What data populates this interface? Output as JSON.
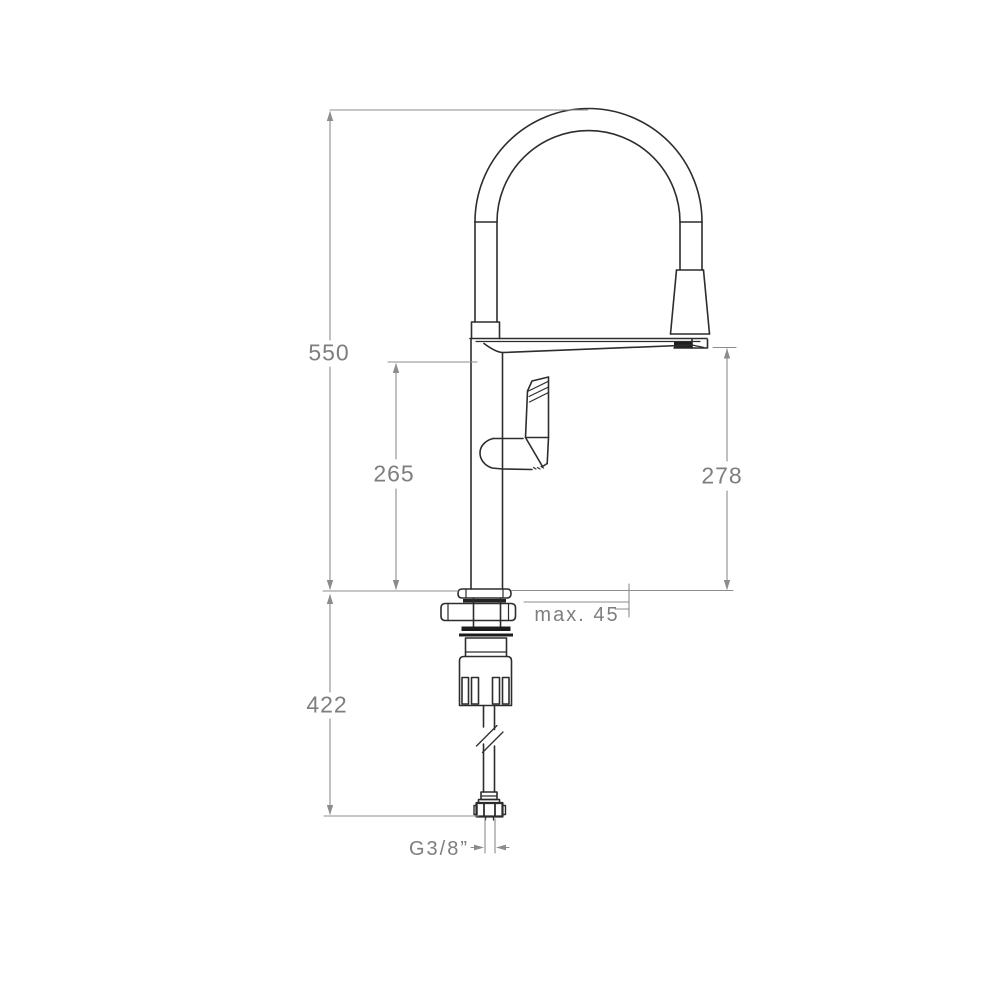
{
  "drawing": {
    "subject": "kitchen-mixer-tap-technical-drawing",
    "view": "front elevation with installation dimensions",
    "line_color": "#2d2d2d",
    "dimension_line_color": "#8c8c8c",
    "text_color": "#7e7e7e",
    "background_color": "#ffffff"
  },
  "dimensions": {
    "total_height": {
      "label": "550"
    },
    "spout_height": {
      "label": "265"
    },
    "outlet_height": {
      "label": "278"
    },
    "deck_thickness": {
      "label": "max. 45"
    },
    "hose_length": {
      "label": "422"
    },
    "connection_thread": {
      "label": "G3/8”"
    }
  }
}
